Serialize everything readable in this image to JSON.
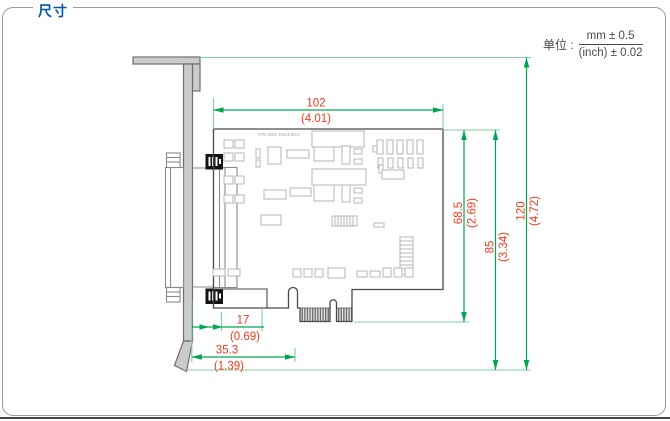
{
  "panel": {
    "title": "尺寸"
  },
  "units": {
    "label": "单位 :",
    "metric": "mm ± 0.5",
    "imperial": "(inch) ± 0.02"
  },
  "board": {
    "part_number": "P/N D00-03LE3G1"
  },
  "dimensions": {
    "width_mm": "102",
    "width_in": "(4.01)",
    "pcb_h_mm": "68.5",
    "pcb_h_in": "(2.69)",
    "mid_h_mm": "85",
    "mid_h_in": "(3.34)",
    "total_h_mm": "120",
    "total_h_in": "(4.72)",
    "conn_off_mm": "17",
    "conn_off_in": "(0.69)",
    "edge_off_mm": "35.3",
    "edge_off_in": "(1.39)"
  },
  "colors": {
    "dimension_line": "#00A651",
    "extension_line": "#7FCFA4",
    "dimension_text": "#EF3B1C",
    "title": "#0058A8",
    "bracket_fill": "#CBCBCB",
    "outline": "#4A4A4A"
  }
}
